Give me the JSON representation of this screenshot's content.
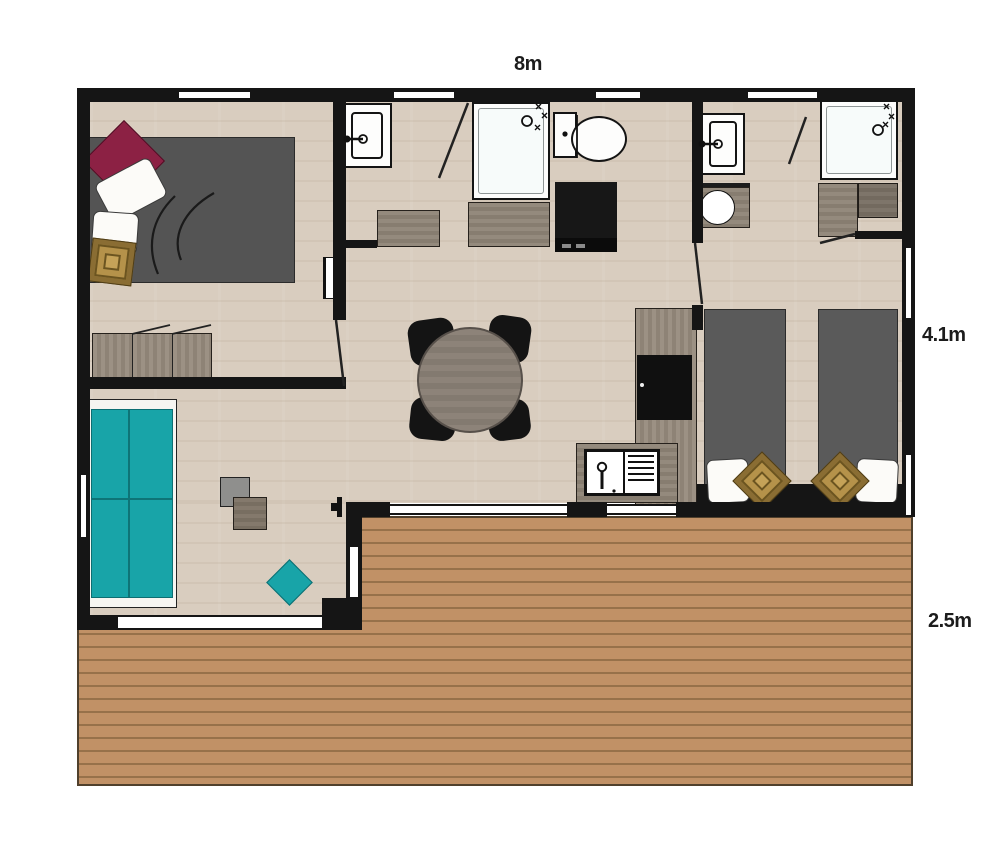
{
  "page": {
    "type": "architectural floor plan, top-down view",
    "background": "#ffffff"
  },
  "labels": {
    "top_width": "8m",
    "right_height": "4.1m",
    "terrace_depth": "2.5m"
  },
  "rooms": [
    {
      "name": "master-bedroom",
      "position": "top-left"
    },
    {
      "name": "shower-room",
      "position": "top-middle"
    },
    {
      "name": "second-shower-room",
      "position": "top-right"
    },
    {
      "name": "twin-bedroom",
      "position": "right"
    },
    {
      "name": "kitchen-dining-hall",
      "position": "center"
    },
    {
      "name": "living-room",
      "position": "bottom-left"
    },
    {
      "name": "terrace-deck",
      "position": "bottom"
    }
  ],
  "furniture": [
    "double-bed",
    "burgundy-cushion",
    "white-pillows",
    "tan-patterned-cushion",
    "wardrobe-with-open-doors",
    "wall-radiator",
    "washbasin",
    "shower-cabin",
    "toilet",
    "vanity-counters",
    "black-kitchen-cabinet",
    "second-washbasin",
    "round-basin-counter",
    "second-shower-cabin",
    "corner-counters",
    "tall-kitchen-unit-with-black-appliance",
    "kitchen-sink-with-drainer",
    "round-dining-table",
    "four-black-chairs",
    "two-single-beds",
    "headboard-band",
    "tan-cushions",
    "teal-sofa",
    "nesting-side-tables",
    "teal-floor-cushion",
    "sliding-glass-doors",
    "wood-deck-planks"
  ],
  "icons": [
    {
      "name": "faucet-icon",
      "meaning": "tap on washbasins and sink"
    },
    {
      "name": "shower-controls-icon",
      "meaning": "shower head and spray marks"
    },
    {
      "name": "door-swing-icon",
      "meaning": "open door leaf line"
    }
  ],
  "colors": {
    "wall": "#151515",
    "floor_wood": "#d9cdbf",
    "counter_wood": "#8d8378",
    "deck_wood": "#c19166",
    "accent_teal": "#18a4a8",
    "accent_burgundy": "#8c2144",
    "cushion_tan": "#b5924a",
    "bed_grey": "#585858"
  }
}
